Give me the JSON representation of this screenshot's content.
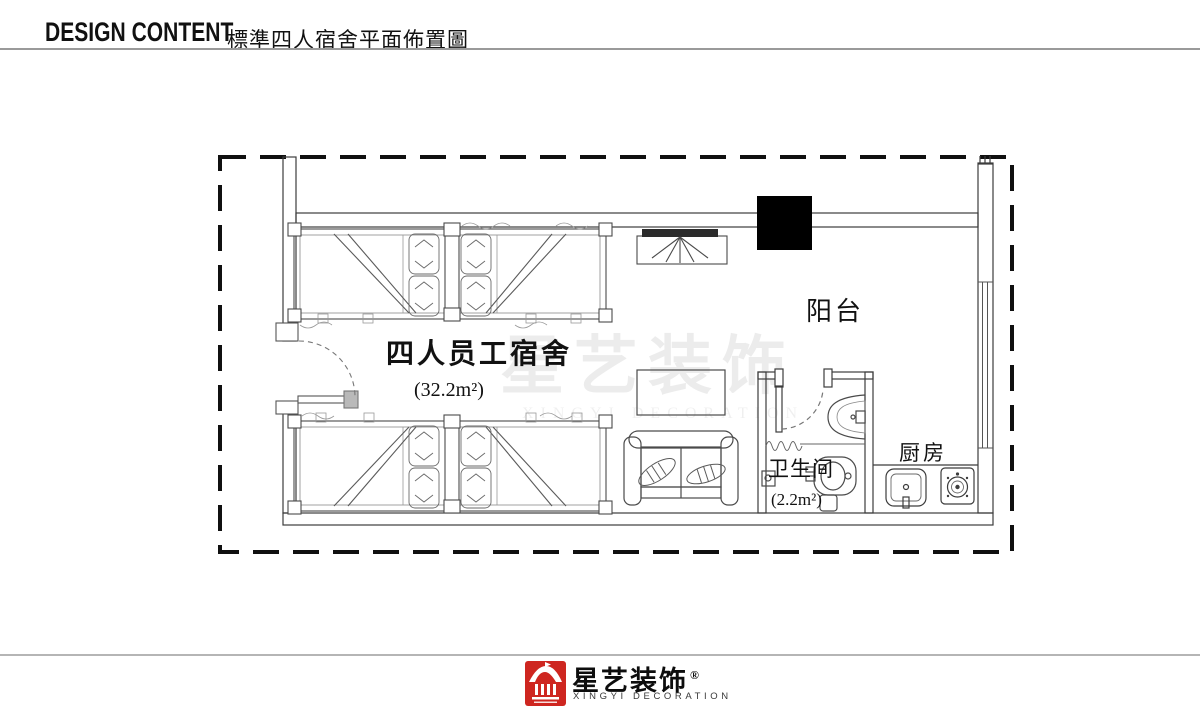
{
  "header": {
    "title_en": "DESIGN CONTENT",
    "title_zh": "標準四人宿舍平面佈置圖"
  },
  "plan": {
    "rooms": {
      "dorm": {
        "label": "四人员工宿舍",
        "area": "(32.2m²)"
      },
      "balcony": {
        "label": "阳台"
      },
      "bathroom": {
        "label": "卫生间",
        "area": "(2.2m²)"
      },
      "kitchen": {
        "label": "厨房"
      }
    }
  },
  "watermark": {
    "brand": "星艺装饰",
    "brand_en": "XINGYI DECORATION"
  },
  "footer": {
    "brand_zh": "星艺装饰",
    "reg_mark": "®",
    "brand_en": "XINGYI DECORATION"
  },
  "colors": {
    "brand_red": "#ce2620",
    "line": "#3c3c3c"
  }
}
